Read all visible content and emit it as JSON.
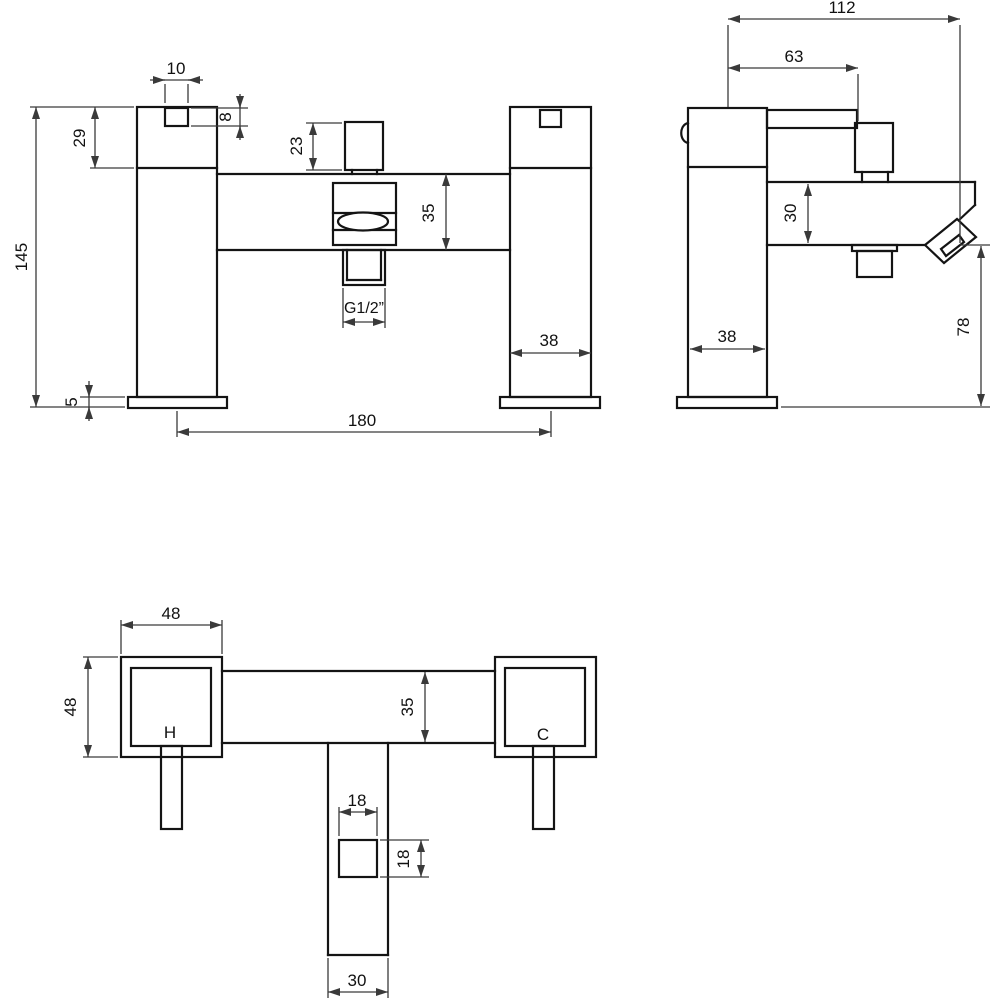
{
  "drawing": {
    "type": "technical-dimension-drawing",
    "subject": "bath shower mixer tap",
    "background_color": "#ffffff",
    "line_color": "#141414",
    "dimension_color": "#3a3a3a",
    "front_view": {
      "dims": {
        "button_width": "10",
        "button_height": "8",
        "handle_height": "29",
        "overall_height": "145",
        "diverter_lever_height": "23",
        "body_height": "35",
        "outlet_thread": "G1/2”",
        "pillar_width": "38",
        "tap_centres": "180",
        "base_plate_height": "5"
      }
    },
    "side_view": {
      "dims": {
        "overall_reach": "112",
        "handle_reach": "63",
        "body_depth": "30",
        "pillar_depth": "38",
        "spout_outlet_height": "78"
      }
    },
    "plan_view": {
      "dims": {
        "handle_width": "48",
        "handle_depth": "48",
        "body_depth": "35",
        "outlet_width": "18",
        "outlet_depth": "18",
        "spout_block_width": "30"
      },
      "labels": {
        "hot": "H",
        "cold": "C"
      }
    }
  }
}
